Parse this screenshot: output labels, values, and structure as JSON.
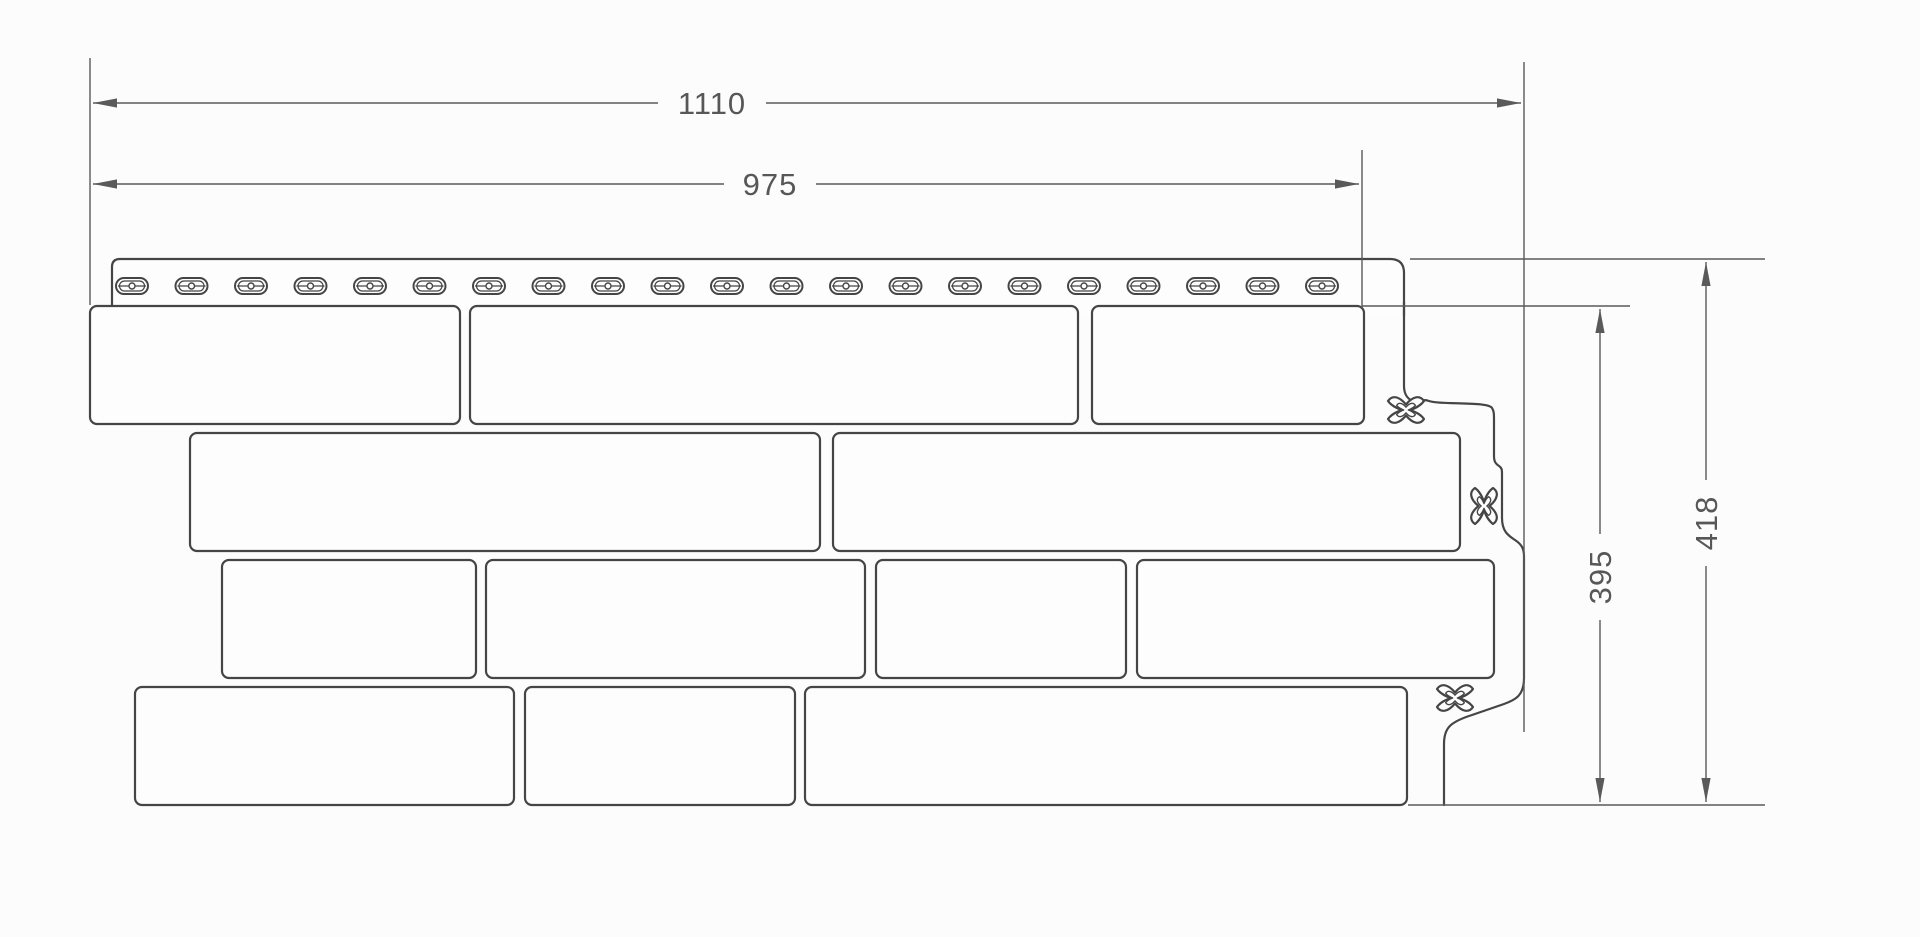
{
  "canvas": {
    "width": 1920,
    "height": 937,
    "background": "#fcfcfc"
  },
  "style": {
    "panel_line_color": "#454545",
    "dim_line_color": "#5a5a5a",
    "panel_fill_color": "#fdfdfd",
    "text_color": "#575757"
  },
  "dimensions": {
    "overall_width": {
      "label": "1110",
      "orientation": "horizontal"
    },
    "nominal_width": {
      "label": "975",
      "orientation": "horizontal"
    },
    "nominal_height": {
      "label": "395",
      "orientation": "vertical"
    },
    "overall_height": {
      "label": "418",
      "orientation": "vertical"
    }
  },
  "panel": {
    "nail_slots": {
      "count": 21,
      "first_cx": 132,
      "spacing": 59.5,
      "cy": 286
    },
    "fastener_marks": [
      {
        "x": 1406,
        "y": 410,
        "orientation": "horizontal"
      },
      {
        "x": 1484,
        "y": 506,
        "orientation": "vertical"
      },
      {
        "x": 1455,
        "y": 698,
        "orientation": "horizontal"
      }
    ],
    "brick_rows": [
      {
        "y": 306,
        "height": 118,
        "bricks": [
          [
            90,
            460
          ],
          [
            470,
            1078
          ],
          [
            1092,
            1364
          ]
        ]
      },
      {
        "y": 433,
        "height": 118,
        "bricks": [
          [
            190,
            820
          ],
          [
            833,
            1460
          ]
        ]
      },
      {
        "y": 560,
        "height": 118,
        "bricks": [
          [
            222,
            476
          ],
          [
            486,
            865
          ],
          [
            876,
            1126
          ],
          [
            1137,
            1494
          ]
        ]
      },
      {
        "y": 687,
        "height": 118,
        "bricks": [
          [
            135,
            514
          ],
          [
            525,
            795
          ],
          [
            805,
            1407
          ]
        ]
      }
    ]
  }
}
